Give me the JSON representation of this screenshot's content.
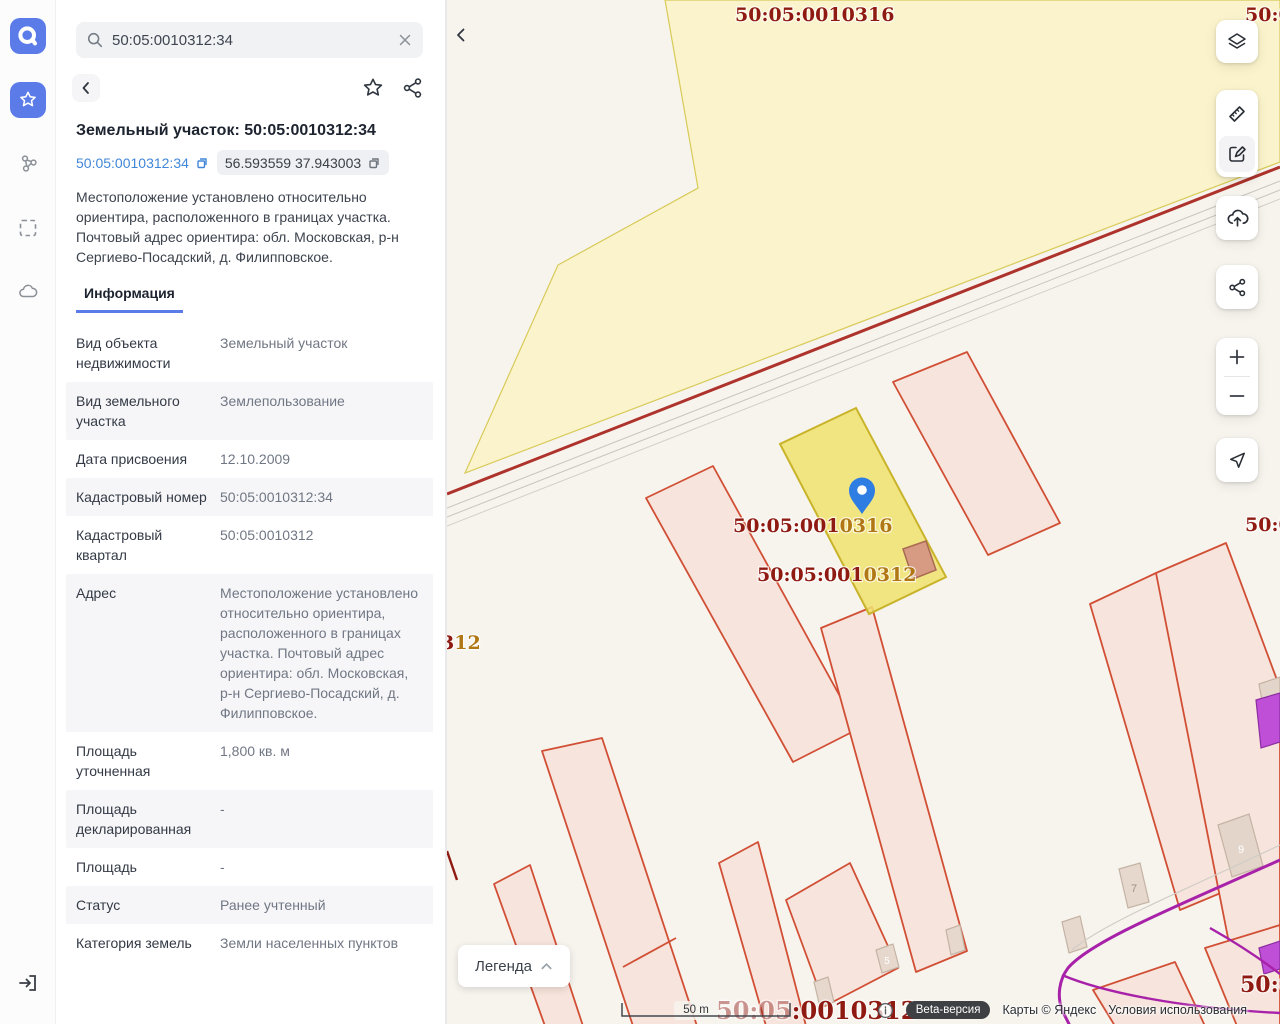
{
  "colors": {
    "accent": "#5b7be8",
    "link": "#4187d8",
    "map_bg": "#f7f4ee",
    "quarter_yellow": "#faf3cb",
    "selected_yellow": "#f0e26e",
    "parcel_pink": "#f7e4dc",
    "parcel_border": "#d14f35",
    "road_red": "#ad332c",
    "label_dark_red": "#8e1a12",
    "label_gold": "#b07714",
    "magenta": "#a722a8",
    "pin_blue": "#2e7de2"
  },
  "search": {
    "query": "50:05:0010312:34"
  },
  "panel": {
    "title": "Земельный участок: 50:05:0010312:34",
    "chip_cadastral": "50:05:0010312:34",
    "chip_coords": "56.593559 37.943003",
    "description": "Местоположение установлено относительно ориентира, расположенного в границах участка. Почтовый адрес ориентира: обл. Московская, р-н Сергиево-Посадский, д. Филипповское.",
    "tab_label": "Информация",
    "rows": [
      {
        "label": "Вид объекта недвижимости",
        "value": "Земельный участок"
      },
      {
        "label": "Вид земельного участка",
        "value": "Землепользование"
      },
      {
        "label": "Дата присвоения",
        "value": "12.10.2009"
      },
      {
        "label": "Кадастровый номер",
        "value": "50:05:0010312:34"
      },
      {
        "label": "Кадастровый квартал",
        "value": "50:05:0010312"
      },
      {
        "label": "Адрес",
        "value": "Местоположение установлено относительно ориентира, расположенного в границах участка. Почтовый адрес ориентира: обл. Московская, р-н Сергиево-Посадский, д. Филипповское."
      },
      {
        "label": "Площадь уточненная",
        "value": "1,800 кв. м"
      },
      {
        "label": "Площадь декларированная",
        "value": "-"
      },
      {
        "label": "Площадь",
        "value": "-"
      },
      {
        "label": "Статус",
        "value": "Ранее учтенный"
      },
      {
        "label": "Категория земель",
        "value": "Земли населенных пунктов"
      }
    ]
  },
  "map": {
    "labels": {
      "quarter_top": "50:05:0010316",
      "top_right_partial": "50:0",
      "parcel1_prefix": "50:05:001",
      "parcel1_suffix": "0316",
      "parcel2_prefix": "50:05:001",
      "parcel2_suffix": "0312",
      "left_partial_prefix": "3",
      "left_partial_suffix": "12",
      "bottom_prefix": "50:05",
      "bottom_suffix": ":0010312",
      "right_mid_partial": "50:0",
      "right_bottom_partial": "50:0"
    },
    "buildings": {
      "b5": "5",
      "b7": "7",
      "b9": "9"
    },
    "scale_label": "50 m",
    "legend_label": "Легенда",
    "attribution": {
      "beta": "Beta-версия",
      "copyright": "Карты © Яндекс",
      "terms": "Условия использования"
    }
  }
}
